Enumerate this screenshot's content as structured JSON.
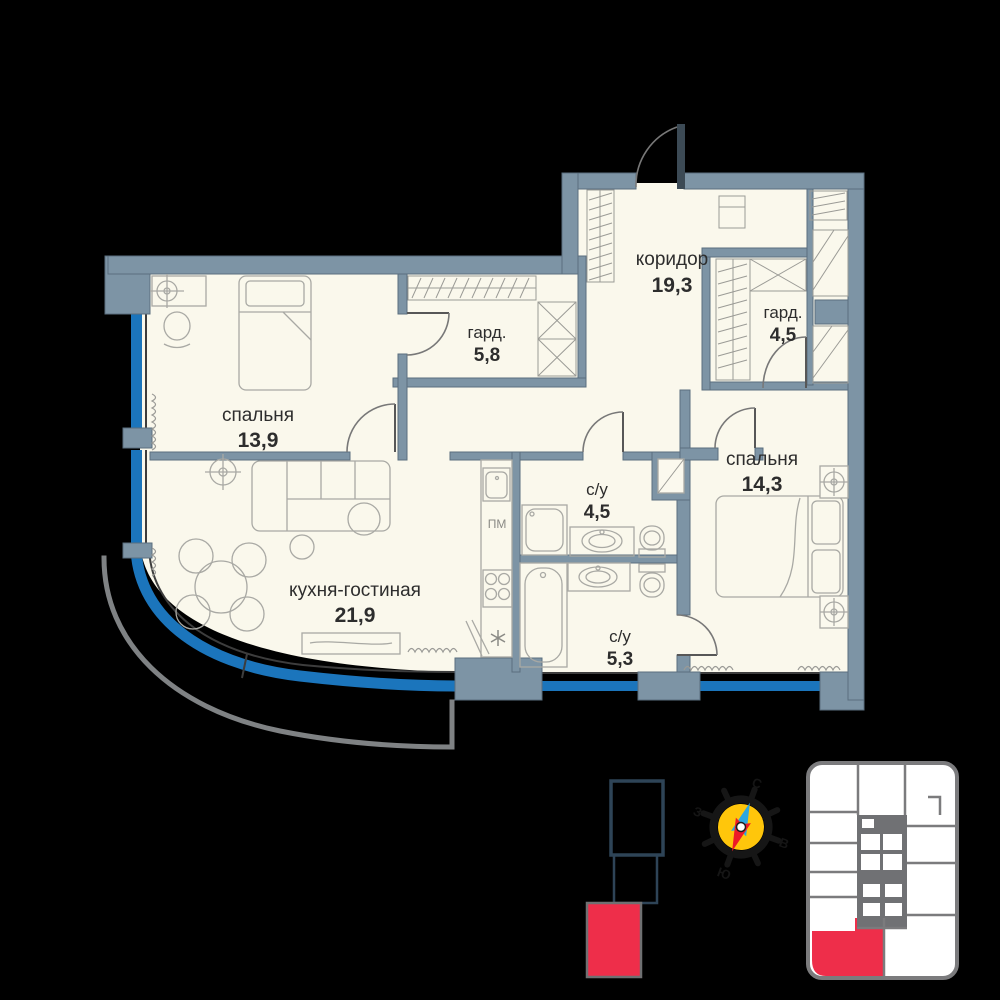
{
  "floor_plan": {
    "rooms": {
      "bedroom_1": {
        "name": "спальня",
        "area": "13,9"
      },
      "wardrobe_1": {
        "name": "гард.",
        "area": "5,8"
      },
      "corridor": {
        "name": "коридор",
        "area": "19,3"
      },
      "wardrobe_2": {
        "name": "гард.",
        "area": "4,5"
      },
      "bedroom_2": {
        "name": "спальня",
        "area": "14,3"
      },
      "bathroom_1": {
        "name": "с/у",
        "area": "4,5"
      },
      "bathroom_2": {
        "name": "с/у",
        "area": "5,3"
      },
      "kitchen_living": {
        "name": "кухня-гостиная",
        "area": "21,9"
      }
    },
    "labels": {
      "dishwasher": "ПМ"
    },
    "colors": {
      "wall": "#7d94a5",
      "floor": "#faf8ec",
      "window_glazing": "#1b75bc",
      "balcony_rail": "#7f8284",
      "highlight_red": "#ee2e4a"
    }
  },
  "compass": {
    "north": "С",
    "east": "В",
    "south": "Ю",
    "west": "З",
    "colors": {
      "disc": "#ffc60b",
      "needle_north": "#2da7e0",
      "needle_south": "#ed1b28"
    }
  },
  "key_plan": {
    "highlight_color": "#ee2e4a"
  },
  "building_diagram": {
    "highlight_color": "#ee2e4a"
  }
}
